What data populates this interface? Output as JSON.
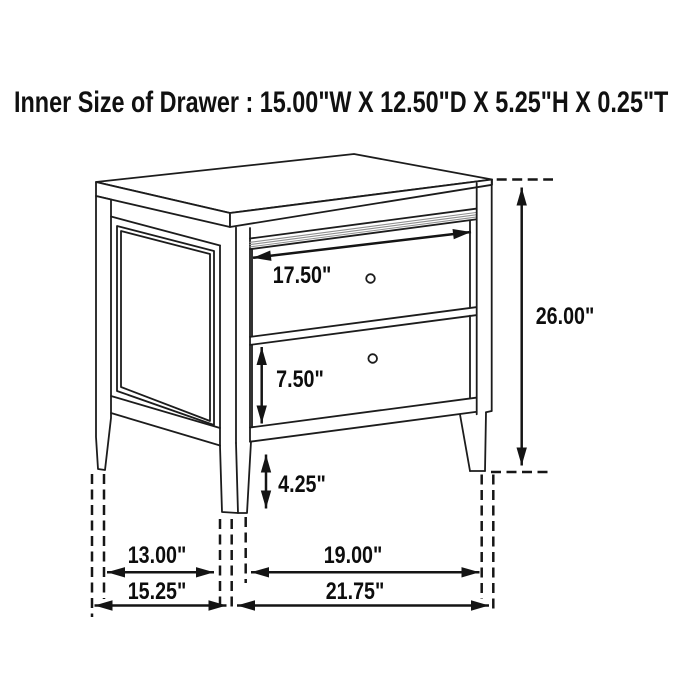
{
  "page": {
    "background": "#ffffff",
    "line_color": "#1c1c1c"
  },
  "title": {
    "text": "Inner Size of Drawer : 15.00\"W X 12.50\"D X 5.25\"H X 0.25\"T"
  },
  "diagram": {
    "description": "Perspective line drawing of a two-drawer nightstand with dimension arrows and dashed extension lines",
    "labels": {
      "drawer_opening_width": "17.50\"",
      "drawer_face_height": "7.50\"",
      "leg_height": "4.25\"",
      "overall_height": "26.00\"",
      "depth_between_legs": "13.00\"",
      "overall_depth": "15.25\"",
      "width_between_legs": "19.00\"",
      "overall_width": "21.75\""
    }
  }
}
